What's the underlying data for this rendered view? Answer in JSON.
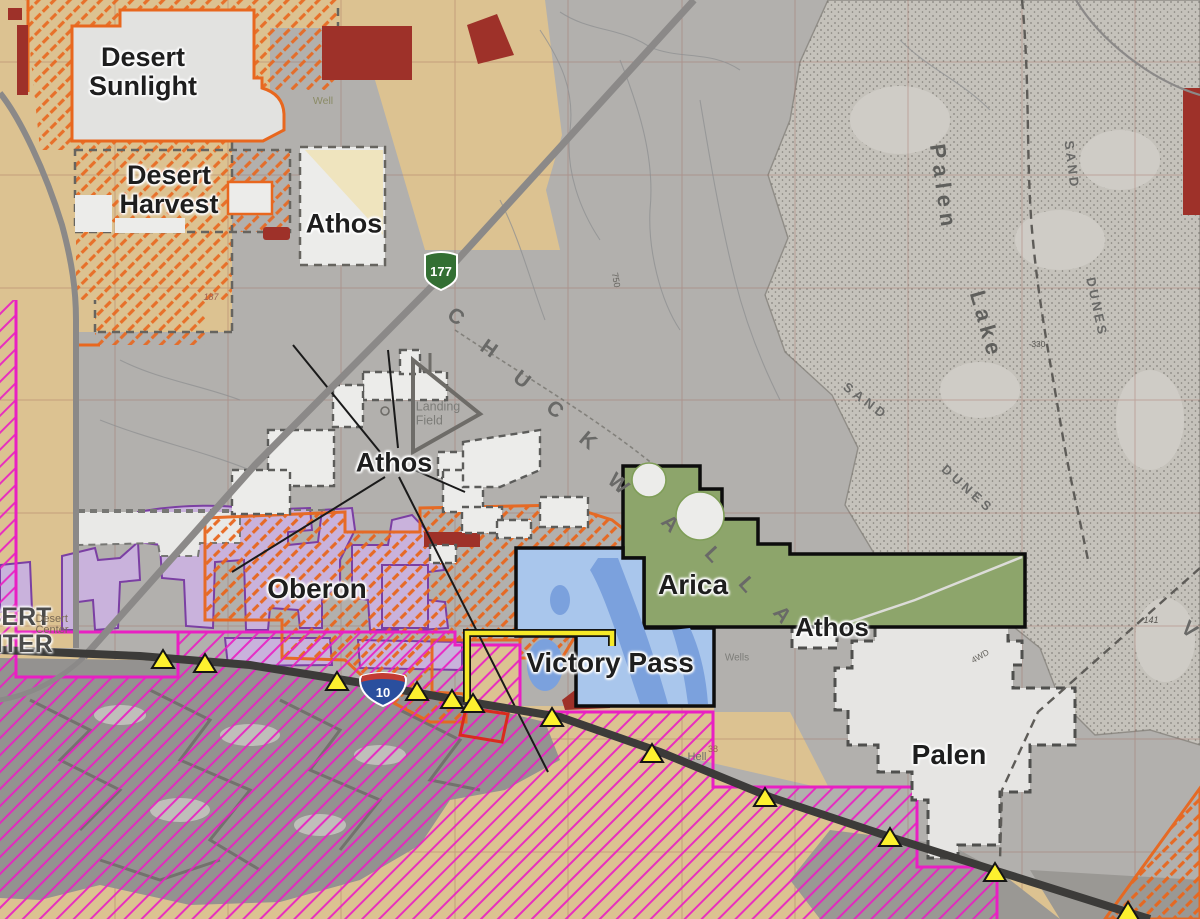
{
  "colors": {
    "base_gray": "#B2B0AD",
    "tan": "#DCC291",
    "pale_tan": "#EFE4BE",
    "orange": "#E8671E",
    "magenta": "#E91FC3",
    "purple_fill": "#C9B2DC",
    "purple_stroke": "#7B3FA3",
    "green_fill": "#8DA56B",
    "blue_fill": "#A9C6EC",
    "blue_water": "#7BA1DD",
    "dark_red": "#9E3129",
    "project_white": "#ECECEA",
    "road_black": "#3C3B39",
    "road_gray": "#8B8988",
    "gen_tie_yellow": "#F6E928",
    "marker_yellow": "#FDF12F",
    "shield_green": "#336F33",
    "shield_blue": "#2A4F9E",
    "shield_red": "#C23B33"
  },
  "projects": [
    {
      "id": "desert-sunlight",
      "line1": "Desert",
      "line2": "Sunlight"
    },
    {
      "id": "desert-harvest",
      "line1": "Desert",
      "line2": "Harvest"
    },
    {
      "id": "athos-north",
      "line1": "Athos"
    },
    {
      "id": "athos-central",
      "line1": "Athos"
    },
    {
      "id": "athos-east",
      "line1": "Athos"
    },
    {
      "id": "oberon",
      "line1": "Oberon"
    },
    {
      "id": "arica",
      "line1": "Arica"
    },
    {
      "id": "victory-pass",
      "line1": "Victory Pass"
    },
    {
      "id": "palen",
      "line1": "Palen"
    }
  ],
  "town": {
    "big_line1": "DESERT",
    "big_line2": "CENTER",
    "small_line1": "Desert",
    "small_line2": "Center"
  },
  "shields": {
    "hwy177": "177",
    "i10": "10"
  },
  "basemap": {
    "valley_letters": [
      {
        "ch": "C"
      },
      {
        "ch": "H"
      },
      {
        "ch": "U"
      },
      {
        "ch": "C"
      },
      {
        "ch": "K"
      },
      {
        "ch": "W"
      },
      {
        "ch": "A"
      },
      {
        "ch": "L"
      },
      {
        "ch": "L"
      },
      {
        "ch": "A"
      },
      {
        "ch": "V"
      }
    ],
    "lake_line1": "Palen",
    "lake_line2": "Lake",
    "dunes1_word1": "SAND",
    "dunes1_word2": "DUNES",
    "dunes2_word1": "SAND",
    "dunes2_word2": "DUNES",
    "landing_field_line1": "Landing",
    "landing_field_line2": "Field",
    "well": "Well",
    "wells": "Wells",
    "hell": "Hell",
    "sec_187": "187",
    "sec_141": "141",
    "sec_38": "38",
    "elev_330": "-330",
    "elev_750": "750",
    "trail_4wd": "4WD"
  }
}
